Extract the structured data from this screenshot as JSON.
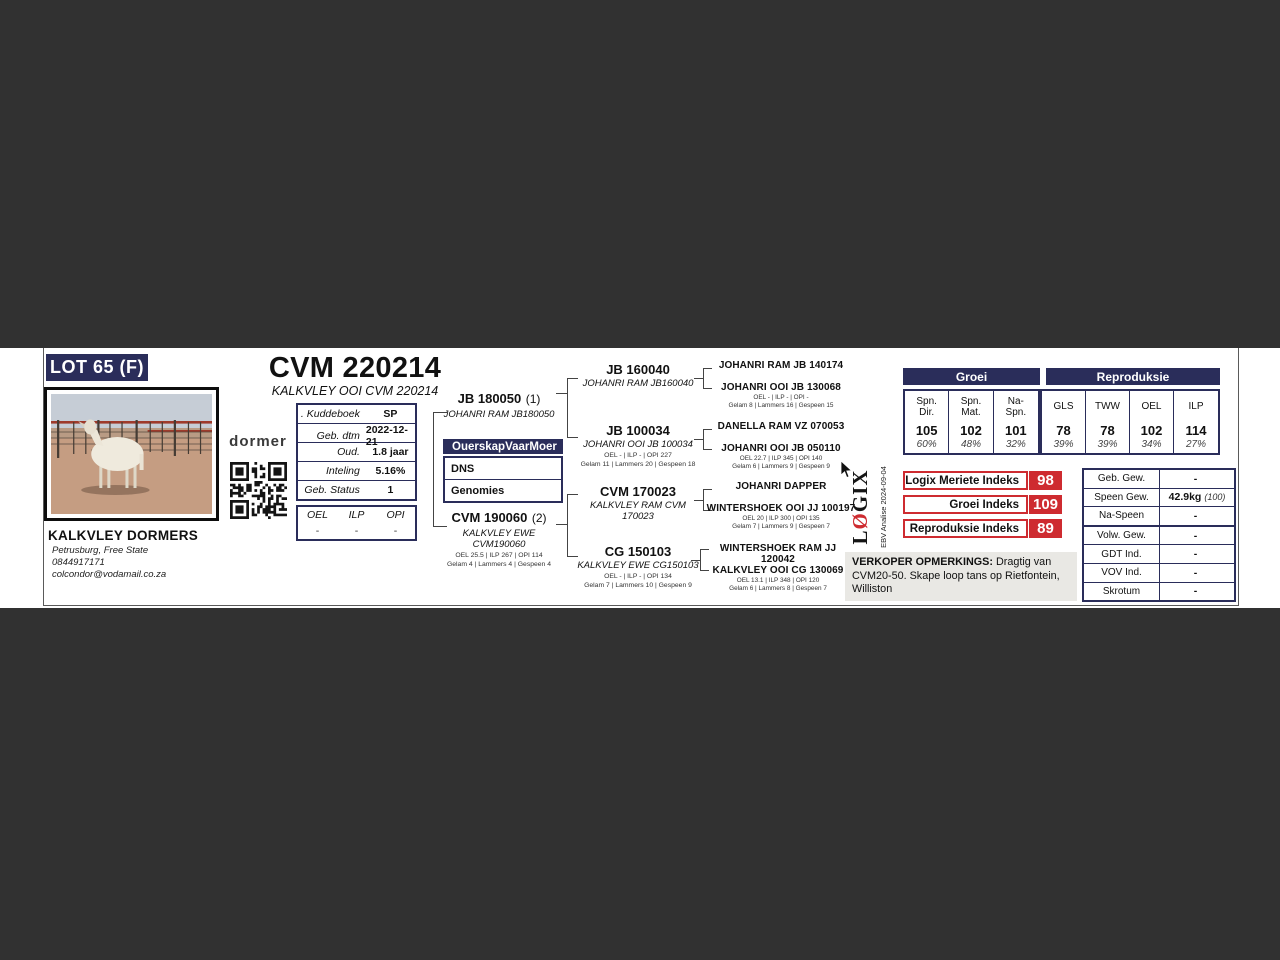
{
  "colors": {
    "navy": "#2a2d5a",
    "red": "#ce2b30",
    "page_bg": "#ffffff",
    "viewer_bg": "#313131",
    "remarks_bg": "#e9e8e4"
  },
  "lot": {
    "label": "LOT 65 (F)"
  },
  "animal": {
    "id": "CVM 220214",
    "full_name": "KALKVLEY OOI CVM 220214"
  },
  "breeder": {
    "name": "KALKVLEY DORMERS",
    "location": "Petrusburg, Free State",
    "phone": "0844917171",
    "email": "colcondor@vodamail.co.za"
  },
  "brand": {
    "dormer": "dormer",
    "logix_l": "L",
    "logix_o": "Ø",
    "logix_rest": "GIX",
    "ebv_note": "EBV Analise 2024-09-04"
  },
  "info": {
    "rows": [
      {
        "label": ". Kuddeboek",
        "value": "SP"
      },
      {
        "label": "Geb. dtm",
        "value": "2022-12-21"
      },
      {
        "label": "Oud.",
        "value": "1.8 jaar"
      },
      {
        "label": "Inteling",
        "value": "5.16%"
      },
      {
        "label": "Geb. Status",
        "value": "1"
      }
    ]
  },
  "oel_box": {
    "headers": [
      "OEL",
      "ILP",
      "OPI"
    ],
    "values": [
      "-",
      "-",
      "-"
    ]
  },
  "parentage": {
    "headers": [
      "Ouerskap",
      "Vaar",
      "Moer"
    ],
    "rows": [
      "DNS",
      "Genomies"
    ]
  },
  "pedigree": {
    "sire": {
      "id": "JB 180050",
      "tag": "(1)",
      "name": "JOHANRI RAM JB180050"
    },
    "dam": {
      "id": "CVM 190060",
      "tag": "(2)",
      "name": "KALKVLEY EWE CVM190060",
      "stats1": "OEL 25.5 | ILP 267 | OPI 114",
      "stats2": "Gelam 4 | Lammers 4 | Gespeen 4"
    },
    "gen2": [
      {
        "id": "JB 160040",
        "name": "JOHANRI RAM JB160040"
      },
      {
        "id": "JB 100034",
        "name": "JOHANRI OOI JB 100034",
        "stats1": "OEL - | ILP - | OPI 227",
        "stats2": "Gelam 11 | Lammers 20 | Gespeen 18"
      },
      {
        "id": "CVM 170023",
        "name": "KALKVLEY RAM CVM 170023"
      },
      {
        "id": "CG 150103",
        "name": "KALKVLEY EWE CG150103",
        "stats1": "OEL - | ILP - | OPI 134",
        "stats2": "Gelam 7 | Lammers 10 | Gespeen 9"
      }
    ],
    "gen3": [
      {
        "name": "JOHANRI RAM JB 140174"
      },
      {
        "name": "JOHANRI OOI JB 130068",
        "stats1": "OEL - | ILP - | OPI -",
        "stats2": "Gelam 8 | Lammers 16 | Gespeen 15"
      },
      {
        "name": "DANELLA RAM VZ 070053"
      },
      {
        "name": "JOHANRI OOI JB 050110",
        "stats1": "OEL 22.7 | ILP 345 | OPI 140",
        "stats2": "Gelam 6 | Lammers 9 | Gespeen 9"
      },
      {
        "name": "JOHANRI DAPPER"
      },
      {
        "name": "WINTERSHOEK OOI JJ 100197",
        "stats1": "OEL 20 | ILP 300 | OPI 135",
        "stats2": "Gelam 7 | Lammers 9 | Gespeen 7"
      },
      {
        "name": "WINTERSHOEK RAM JJ 120042"
      },
      {
        "name": "KALKVLEY OOI CG 130069",
        "stats1": "OEL 13.1 | ILP 348 | OPI 120",
        "stats2": "Gelam 6 | Lammers 8 | Gespeen 7"
      }
    ]
  },
  "ebv": {
    "groei_header": "Groei",
    "repro_header": "Reproduksie",
    "columns": [
      {
        "label": "Spn. Dir.",
        "value": "105",
        "acc": "60%"
      },
      {
        "label": "Spn. Mat.",
        "value": "102",
        "acc": "48%"
      },
      {
        "label": "Na- Spn.",
        "value": "101",
        "acc": "32%"
      },
      {
        "label": "GLS",
        "value": "78",
        "acc": "39%"
      },
      {
        "label": "TWW",
        "value": "78",
        "acc": "39%"
      },
      {
        "label": "OEL",
        "value": "102",
        "acc": "34%"
      },
      {
        "label": "ILP",
        "value": "114",
        "acc": "27%"
      }
    ]
  },
  "indices": [
    {
      "label": "Logix Meriete Indeks",
      "value": "98"
    },
    {
      "label": "Groei Indeks",
      "value": "109"
    },
    {
      "label": "Reproduksie Indeks",
      "value": "89"
    }
  ],
  "remarks": {
    "title": "VERKOPER OPMERKINGS:",
    "body": " Dragtig van CVM20-50. Skape loop tans op Rietfontein, Williston"
  },
  "weights": {
    "rows": [
      {
        "label": "Geb. Gew.",
        "value": "-",
        "acc": ""
      },
      {
        "label": "Speen Gew.",
        "value": "42.9kg",
        "acc": "(100)"
      },
      {
        "label": "Na-Speen",
        "value": "-",
        "acc": ""
      },
      {
        "label": "Volw. Gew.",
        "value": "-",
        "acc": ""
      },
      {
        "label": "GDT Ind.",
        "value": "-",
        "acc": ""
      },
      {
        "label": "VOV Ind.",
        "value": "-",
        "acc": ""
      },
      {
        "label": "Skrotum",
        "value": "-",
        "acc": ""
      }
    ]
  }
}
